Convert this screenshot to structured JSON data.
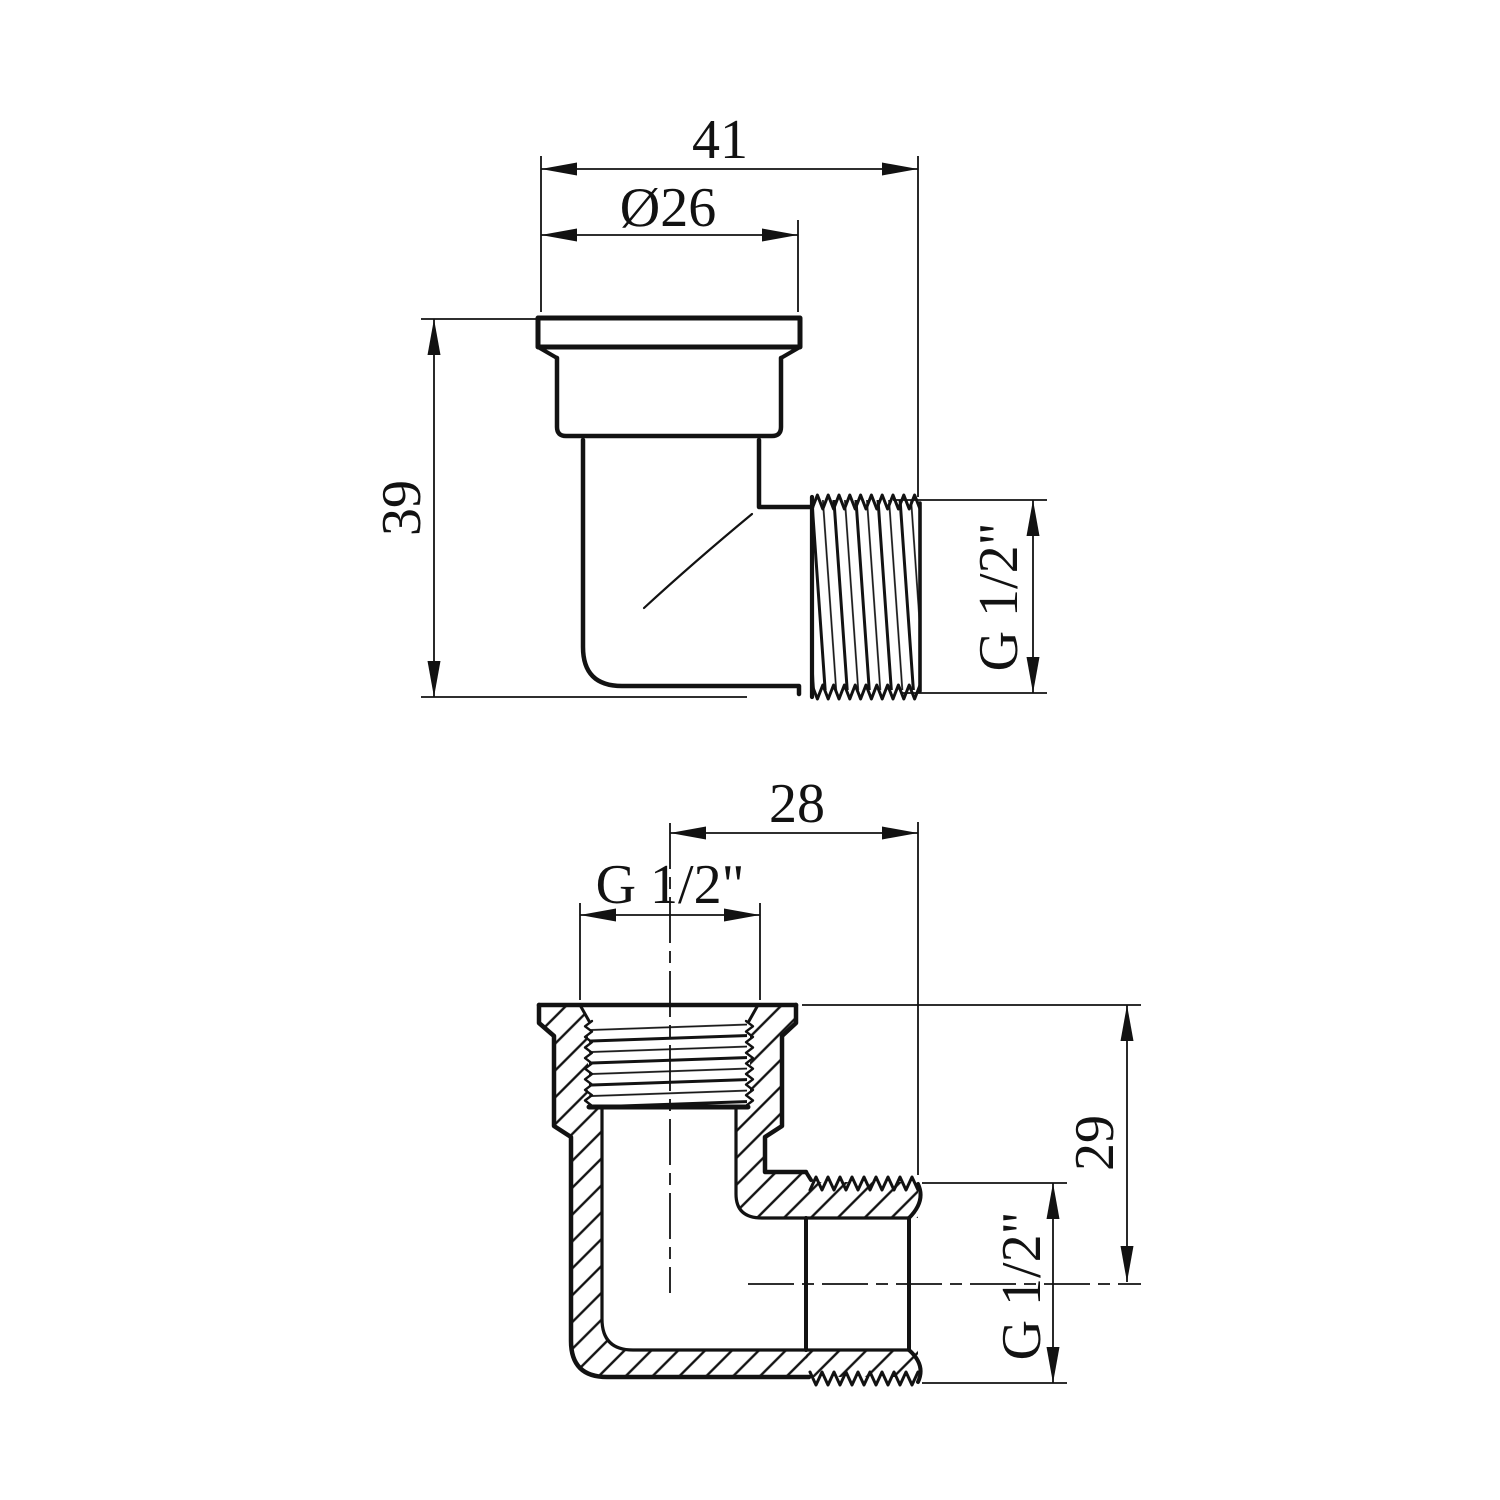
{
  "canvas": {
    "background": "#ffffff",
    "line_color": "#121212"
  },
  "top_view": {
    "dims": {
      "overall_width": "41",
      "cap_diameter": "Ø26",
      "overall_height": "39",
      "male_thread": "G 1/2\""
    }
  },
  "bottom_view": {
    "dims": {
      "center_to_end": "28",
      "female_thread": "G 1/2\"",
      "center_height": "29",
      "male_thread": "G 1/2\""
    }
  }
}
